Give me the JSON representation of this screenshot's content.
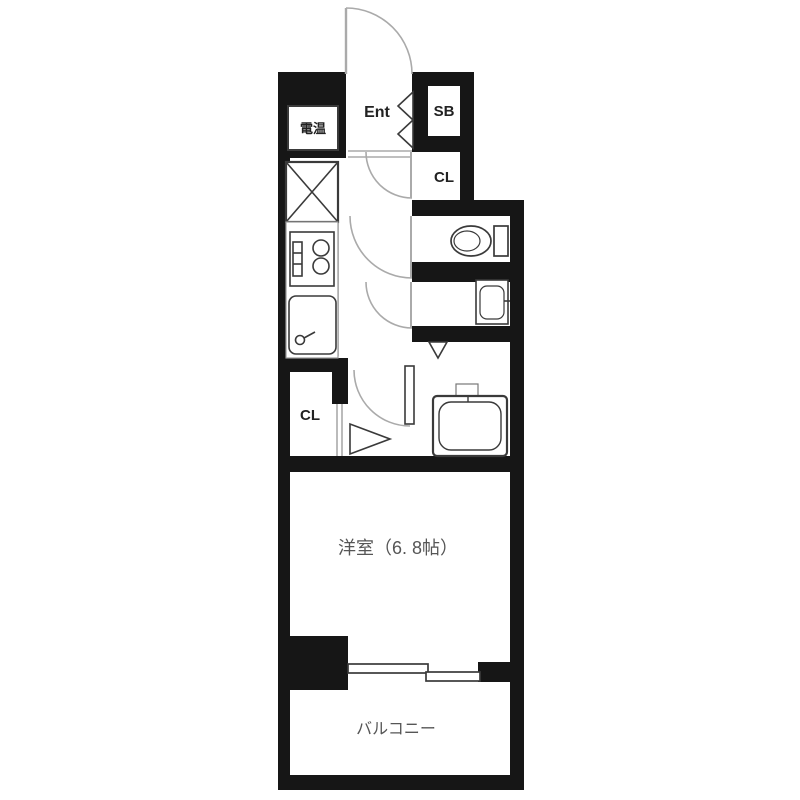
{
  "floorplan": {
    "labels": {
      "entrance": "Ent",
      "shoe_box": "SB",
      "closet_upper": "CL",
      "closet_lower": "CL",
      "water_heater": "電温",
      "main_room": "洋室（6. 8帖）",
      "balcony": "バルコニー"
    },
    "colors": {
      "wall": "#161616",
      "fixture_line": "#3a3a3a",
      "thin_line": "#999999",
      "door_line": "#aaaaaa",
      "room_label": "#565656",
      "compartment_label": "#222222"
    }
  }
}
